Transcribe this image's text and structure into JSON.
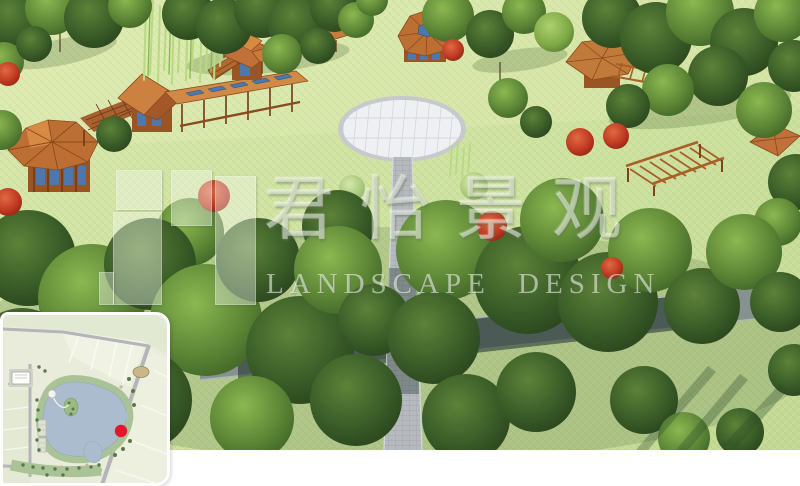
{
  "watermark": {
    "title": "君怡景观",
    "subtitle": "LANDSCAPE DESIGN"
  },
  "inset_map": {
    "marker_color": "#e4162b",
    "lake_color": "#aabccd"
  },
  "palette": {
    "lawn": "#cde19e",
    "canopy_dark": "#2c4a1f",
    "wood": "#c07a3a",
    "plaza": "#eef0f3",
    "road_shadow": "#2a3f38"
  }
}
